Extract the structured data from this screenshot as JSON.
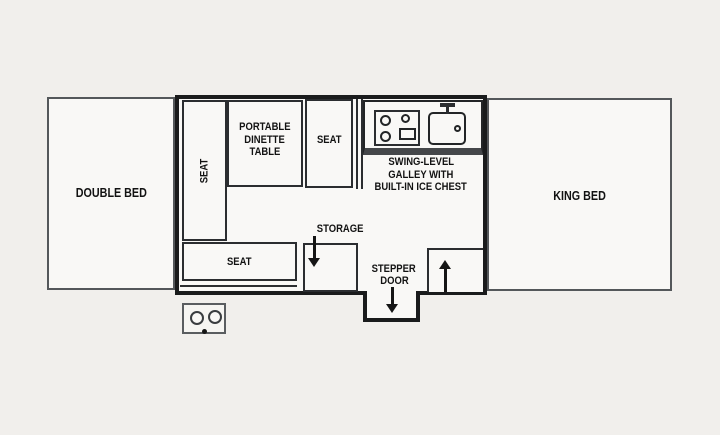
{
  "title": "Pop-up camper floor plan",
  "colors": {
    "background": "#f1efec",
    "floor": "#f9f8f6",
    "outline_heavy": "#1a1b1c",
    "outline_light": "#54575a",
    "interior_line": "#2b2d30",
    "counter_band": "#45474a",
    "text": "#121212"
  },
  "plan": {
    "double_bed": {
      "label": "DOUBLE BED"
    },
    "king_bed": {
      "label": "KING BED"
    },
    "side_seat": {
      "label": "SEAT"
    },
    "dinette_table": {
      "lines": [
        "PORTABLE",
        "DINETTE",
        "TABLE"
      ]
    },
    "dinette_seat": {
      "label": "SEAT"
    },
    "galley": {
      "lines": [
        "SWING-LEVEL",
        "GALLEY WITH",
        "BUILT-IN ICE CHEST"
      ],
      "stove_icon": "two-burner-stove-icon",
      "sink_icon": "sink-with-faucet-icon"
    },
    "bench_seat": {
      "label": "SEAT"
    },
    "storage": {
      "label": "STORAGE",
      "arrow_icon": "down-arrow-icon"
    },
    "stepper_door": {
      "lines": [
        "STEPPER",
        "DOOR"
      ],
      "arrow_icon": "down-arrow-icon"
    },
    "entry": {
      "arrow_icon": "up-arrow-icon"
    },
    "exterior_stove_icon": "two-burner-stove-icon"
  }
}
